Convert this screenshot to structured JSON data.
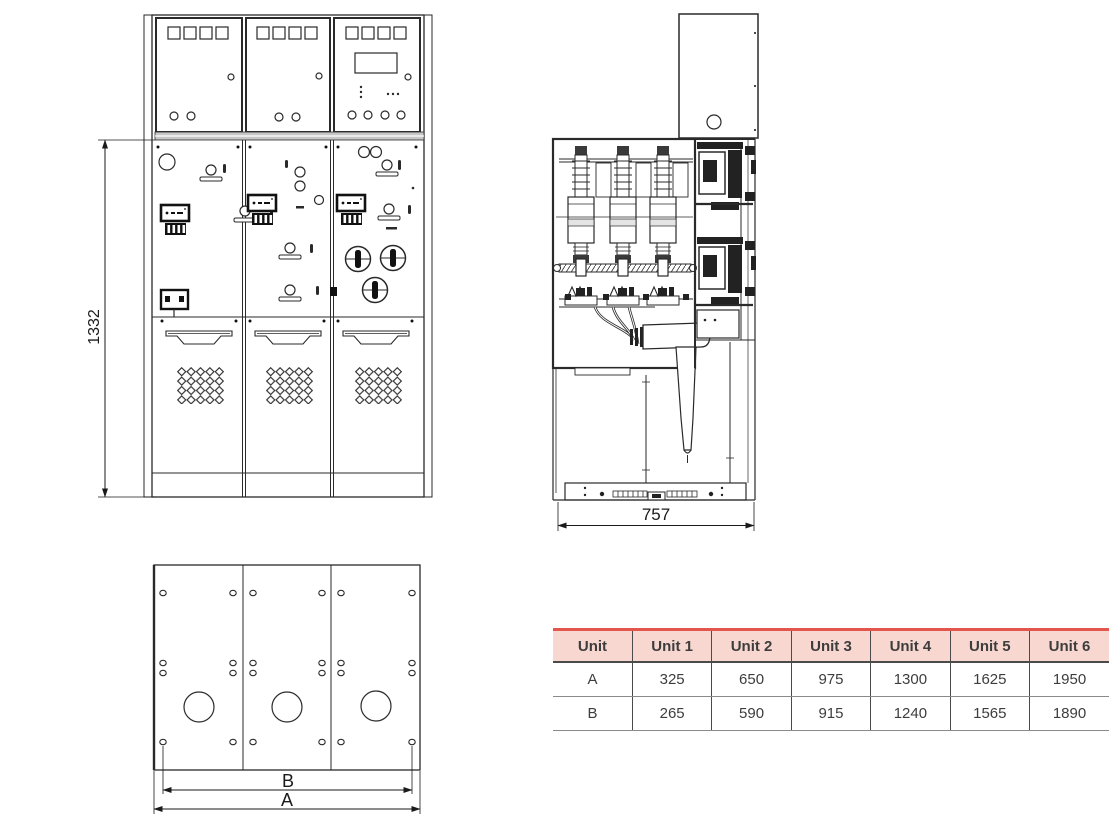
{
  "front_view": {
    "height_label": "1332"
  },
  "side_view": {
    "width_label": "757"
  },
  "plan_view": {
    "inner_width_label": "B",
    "outer_width_label": "A"
  },
  "table": {
    "header": [
      "Unit",
      "Unit 1",
      "Unit 2",
      "Unit 3",
      "Unit 4",
      "Unit 5",
      "Unit 6"
    ],
    "rows": [
      {
        "label": "A",
        "values": [
          "325",
          "650",
          "975",
          "1300",
          "1625",
          "1950"
        ]
      },
      {
        "label": "B",
        "values": [
          "265",
          "590",
          "915",
          "1240",
          "1565",
          "1890"
        ]
      }
    ]
  },
  "chart_data": {
    "type": "table",
    "columns": [
      "Unit",
      "Unit 1",
      "Unit 2",
      "Unit 3",
      "Unit 4",
      "Unit 5",
      "Unit 6"
    ],
    "rows": [
      [
        "A",
        325,
        650,
        975,
        1300,
        1625,
        1950
      ],
      [
        "B",
        265,
        590,
        915,
        1240,
        1565,
        1890
      ]
    ],
    "title": "Switchgear overall dimensions (mm): height 1332, depth 757, widths A/B per number of units"
  },
  "colors": {
    "line": "#2a2a2a",
    "table_header_bg": "#f8d7d0",
    "table_accent": "#e2564b"
  }
}
